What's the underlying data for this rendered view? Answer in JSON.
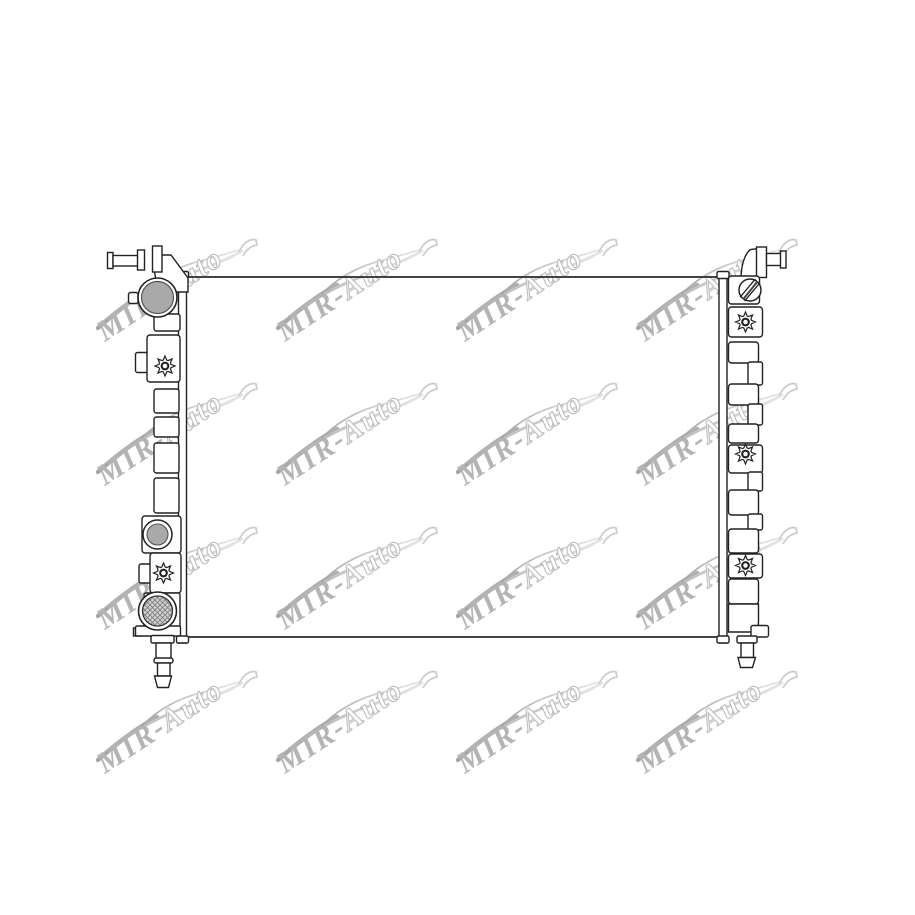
{
  "page": {
    "background_color": "#ffffff"
  },
  "watermark": {
    "brand_prefix": "MIR-",
    "brand_suffix": "Auto",
    "full_text": "MIR-Auto",
    "text_color": "#a2a2a2",
    "outline_letter_fill": "#ffffff",
    "outline_letter_stroke": "#aeaeae",
    "swoosh_color_dark": "#8f8f8f",
    "swoosh_color_light": "#e2e2e2",
    "grid": {
      "columns": 4,
      "rows": 4,
      "tile_count": 16
    }
  },
  "drawing": {
    "subject": "radiator-front-view-line-drawing",
    "line_color": "#222222",
    "body_fill_color": "#ffffff",
    "cap_disc_color": "#a9a9a9",
    "hatch_base_color": "#d2d2d2",
    "hatch_line_color": "#7f7f7f",
    "icons": [
      "star-bolt-icon",
      "screw-plug-icon",
      "filler-cap-icon",
      "hatched-drain-port-icon"
    ]
  }
}
